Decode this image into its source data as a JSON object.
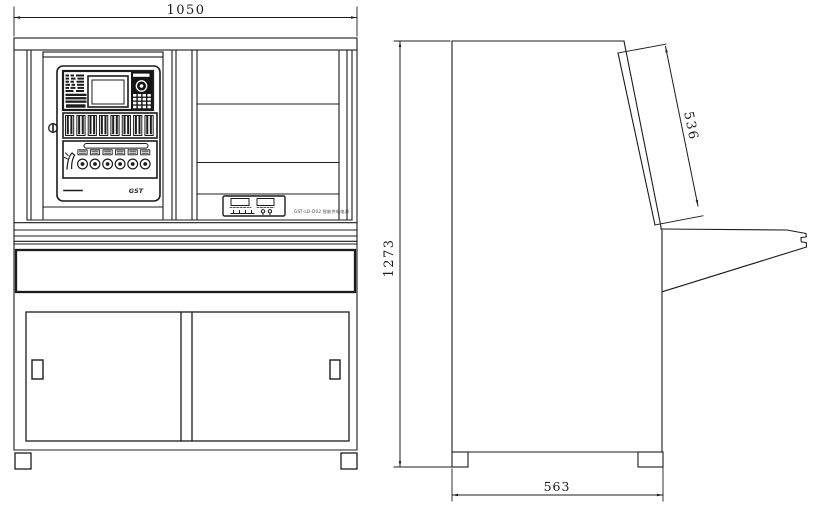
{
  "drawing": {
    "background": "#ffffff",
    "line_color": "#1c1c1c",
    "dim_front_width": "1050",
    "dim_overall_height": "1273",
    "dim_panel_length": "536",
    "dim_base_depth": "563",
    "panel_brand_mark": "GST",
    "power_unit_label": "GST-LD-D02 智能供电电源"
  }
}
